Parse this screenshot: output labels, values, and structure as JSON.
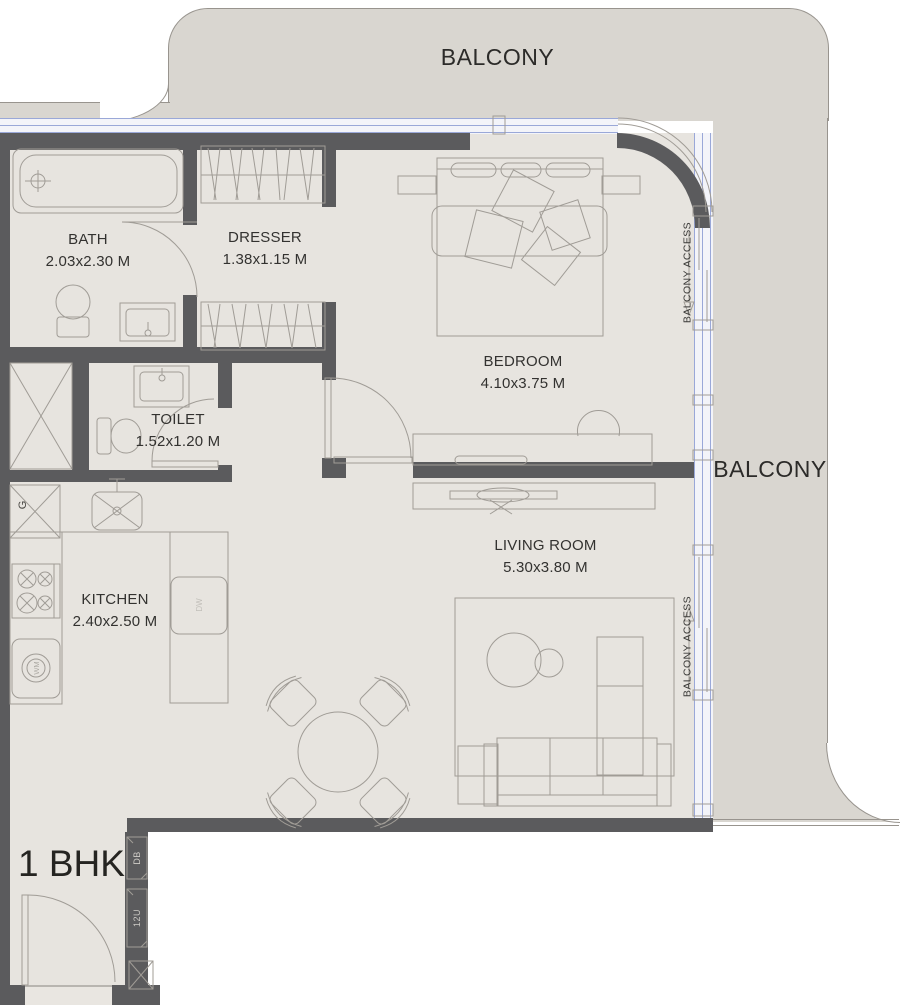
{
  "unit": {
    "label": "1 BHK"
  },
  "balcony": {
    "top_label": "BALCONY",
    "right_label": "BALCONY",
    "access_bedroom_label": "BALCONY ACCESS",
    "access_living_label": "BALCONY ACCESS"
  },
  "rooms": {
    "bath": {
      "name": "BATH",
      "dims": "2.03x2.30 M"
    },
    "dresser": {
      "name": "DRESSER",
      "dims": "1.38x1.15 M"
    },
    "bedroom": {
      "name": "BEDROOM",
      "dims": "4.10x3.75 M"
    },
    "toilet": {
      "name": "TOILET",
      "dims": "1.52x1.20 M"
    },
    "kitchen": {
      "name": "KITCHEN",
      "dims": "2.40x2.50 M"
    },
    "living_room": {
      "name": "LIVING ROOM",
      "dims": "5.30x3.80 M"
    }
  },
  "equipment": {
    "distribution_board": "DB",
    "shaft_12u": "12U",
    "gas_shaft": "G",
    "washing_machine": "WM",
    "dishwasher": "DW"
  },
  "colors": {
    "wall": "#5b5b5d",
    "floor_indoor": "#e7e4df",
    "floor_balcony": "#d9d6d0",
    "window_line": "#9aa8d8",
    "furniture_line": "#a09c96",
    "text": "#2e2d2b"
  }
}
